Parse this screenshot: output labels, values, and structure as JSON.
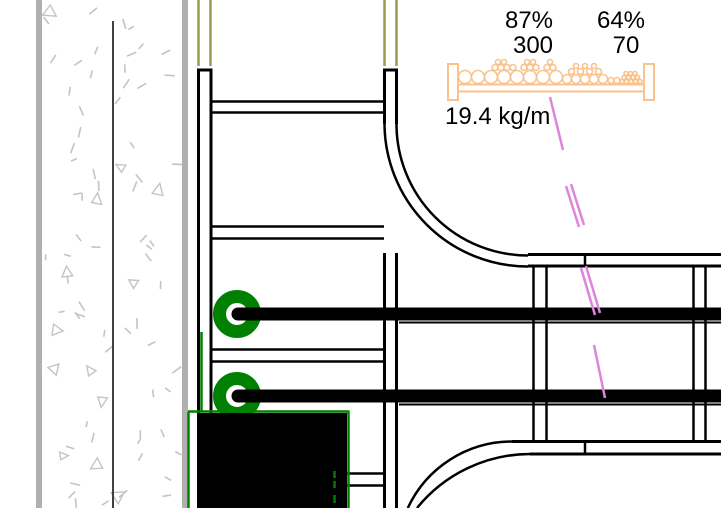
{
  "annotations": {
    "tray1_fill_percent": "87%",
    "tray1_capacity": "300",
    "tray2_fill_percent": "64%",
    "tray2_capacity": "70",
    "weight_per_meter": "19.4 kg/m"
  },
  "colors": {
    "bg": "#ffffff",
    "line_black": "#000000",
    "wall_gray": "#b0b0b0",
    "wall_core": "#404040",
    "stipple_gray": "#c4c4c4",
    "duct_olive": "#9b9b4f",
    "cable_green": "#008000",
    "tray_orange": "#f9c38d",
    "leader_magenta": "#dd85dd"
  },
  "tray_symbol": {
    "circles": [
      [
        465,
        77,
        6.5
      ],
      [
        478,
        77,
        6.5
      ],
      [
        491,
        77,
        6.5
      ],
      [
        504,
        77,
        6.5
      ],
      [
        517,
        77,
        6.5
      ],
      [
        530,
        77,
        6.5
      ],
      [
        543,
        77,
        6.5
      ],
      [
        556,
        77,
        6.5
      ],
      [
        495,
        67.5,
        3
      ],
      [
        501,
        67.5,
        3
      ],
      [
        507,
        67.5,
        3
      ],
      [
        513,
        67.5,
        3
      ],
      [
        524,
        67.5,
        3
      ],
      [
        530,
        67.5,
        3
      ],
      [
        536,
        67.5,
        3
      ],
      [
        547,
        67.5,
        3
      ],
      [
        553,
        67.5,
        3
      ],
      [
        498,
        62,
        2.5
      ],
      [
        504,
        62,
        2.5
      ],
      [
        527,
        62,
        2.5
      ],
      [
        533,
        62,
        2.5
      ],
      [
        550,
        62,
        2.5
      ],
      [
        567,
        79,
        4.5
      ],
      [
        576,
        79,
        4.5
      ],
      [
        585,
        79,
        4.5
      ],
      [
        594,
        79,
        4.5
      ],
      [
        603,
        79,
        4.5
      ],
      [
        571.5,
        71.5,
        3
      ],
      [
        580.5,
        71.5,
        3
      ],
      [
        589.5,
        71.5,
        3
      ],
      [
        598.5,
        71.5,
        3
      ],
      [
        576,
        66,
        2.5
      ],
      [
        585,
        66,
        2.5
      ],
      [
        594,
        66,
        2.5
      ],
      [
        611,
        80.5,
        3
      ],
      [
        617,
        80.5,
        3
      ],
      [
        622,
        81.5,
        2
      ],
      [
        626.5,
        81.5,
        2
      ],
      [
        631,
        81.5,
        2
      ],
      [
        635.5,
        81.5,
        2
      ],
      [
        640,
        81.5,
        2
      ],
      [
        624,
        77.5,
        2
      ],
      [
        628.5,
        77.5,
        2
      ],
      [
        633,
        77.5,
        2
      ],
      [
        637.5,
        77.5,
        2
      ],
      [
        626,
        73.5,
        2
      ],
      [
        630.5,
        73.5,
        2
      ],
      [
        635,
        73.5,
        2
      ]
    ]
  },
  "stipple": {
    "seed": 11,
    "dash_count": 66,
    "triangle_count": 13
  }
}
